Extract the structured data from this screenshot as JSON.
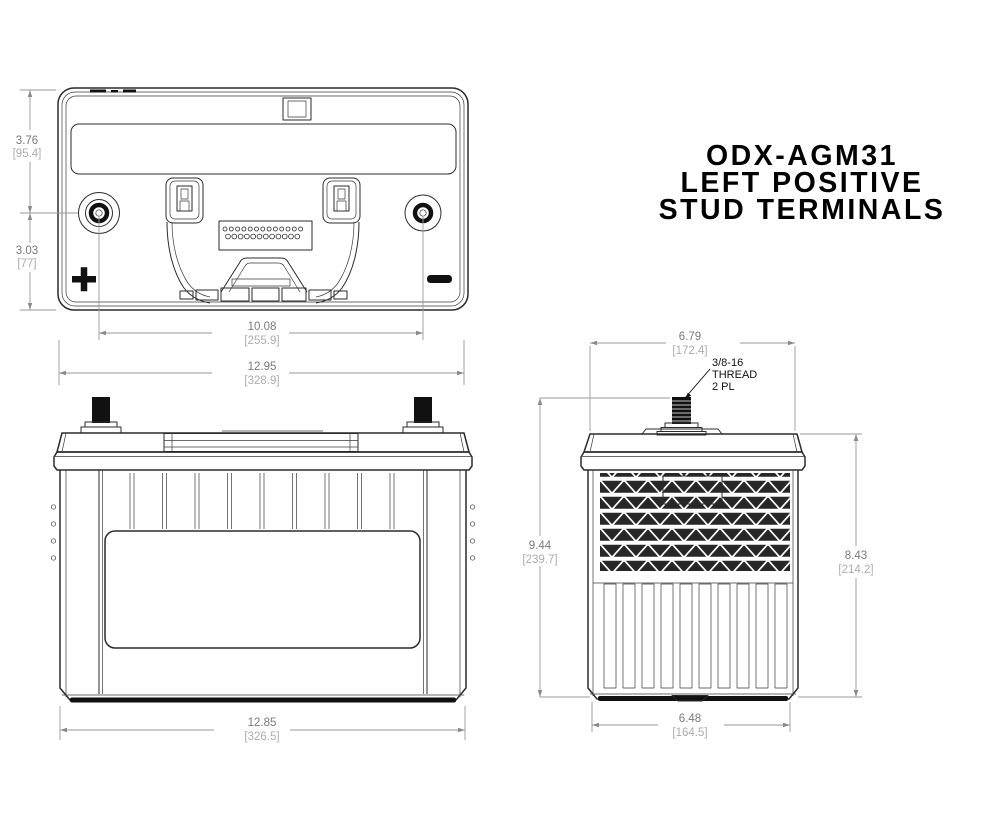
{
  "title": {
    "line1": "ODX-AGM31",
    "line2": "LEFT POSITIVE",
    "line3": "STUD TERMINALS"
  },
  "dims": {
    "top_height_upper": {
      "in": "3.76",
      "mm": "[95.4]"
    },
    "top_height_lower": {
      "in": "3.03",
      "mm": "[77]"
    },
    "terminal_spacing": {
      "in": "10.08",
      "mm": "[255.9]"
    },
    "overall_width": {
      "in": "12.95",
      "mm": "[328.9]"
    },
    "front_base_width": {
      "in": "12.85",
      "mm": "[326.5]"
    },
    "side_top_width": {
      "in": "6.79",
      "mm": "[172.4]"
    },
    "overall_height": {
      "in": "9.44",
      "mm": "[239.7]"
    },
    "case_height": {
      "in": "8.43",
      "mm": "[214.2]"
    },
    "side_base_width": {
      "in": "6.48",
      "mm": "[164.5]"
    }
  },
  "thread_callout": {
    "line1": "3/8-16",
    "line2": "THREAD",
    "line3": "2 PL"
  },
  "icons": {
    "positive_marker": "plus-symbol",
    "negative_marker": "minus-symbol"
  },
  "colors": {
    "line": "#2b2b2b",
    "fill_dark": "#111111",
    "dim_line": "#9a9a9a",
    "dim_text": "#7a7a7a",
    "dim_bracket": "#aeaeae",
    "background": "#ffffff"
  }
}
